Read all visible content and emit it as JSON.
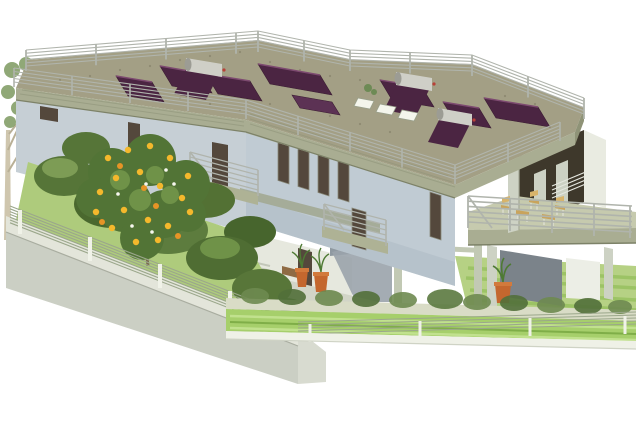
{
  "meta": {
    "title": "Architectural 3D rendering: modern two-storey villa with flat roof terrace, rooftop solar thermal panels, balconies, gardens and fenced retaining wall",
    "type": "3d-architectural-visualization",
    "objects": [
      "roof-terrace-with-railing",
      "solar-thermal-panels",
      "solar-water-heaters",
      "skylights",
      "left-wing-facade",
      "central-facade-windows",
      "balconies",
      "covered-porch",
      "large-terrace-with-furniture",
      "pilotis-columns",
      "ground-patio",
      "terracotta-planters",
      "citrus-tree-with-fruit",
      "background-tree",
      "left-garden-shrubs",
      "retaining-wall-with-wire-fence",
      "front-hedge-row",
      "front-fence",
      "striped-lawn"
    ]
  },
  "colors": {
    "background": "#ffffff",
    "roof_deck": "#a39f85",
    "roof_fascia": "#a9ad92",
    "roof_fascia_dark": "#8f9377",
    "deck_stripe": "#8f9579",
    "speckle": "#7e7862",
    "facade": "#c0cbd3",
    "facade_shade": "#aab7c0",
    "facade_left": "#c6cfd5",
    "window_glass": "#54483c",
    "porch_dark": "#3e382b",
    "porch_panel": "#ccd1c3",
    "panel": "#4b2542",
    "panel_edge": "#7d4a70",
    "panel_flat": "#5c3254",
    "tank": "#cfcfc7",
    "tank_cap": "#9c9c94",
    "tank_dot": "#b84038",
    "railing_gray": "#b0b4ac",
    "railing_white": "#e5e7df",
    "terrace_floor": "#c6caae",
    "slab": "#a9ad92",
    "column": "#cdd2c4",
    "column_green": "#c2c9b4",
    "shadow_wall": "#7b838a",
    "stair_shadow": "#9aa3ab",
    "ground_wall": "#e6e8de",
    "patio": "#d2d5c7",
    "wall_top": "#e3e5da",
    "wall_face": "#cbcfc4",
    "wall_end": "#d8dbd0",
    "fence_wire": "#9ba78b",
    "fence_post": "#f0f2e8",
    "lawn_left": "#aecb7c",
    "lawn_right": "#b6d184",
    "lawn_stripe": "#96c05e",
    "path_tan": "#d9dcc6",
    "band_bright": "#a6cf6b",
    "band_stripe": "#c4e292",
    "curb": "#eff1e7",
    "hedge_dark": "#52703a",
    "hedge_mid": "#6e8a50",
    "blob_dark": "#4a682e",
    "blob_mid": "#567538",
    "blob_light": "#7d9c55",
    "citrus_green": "#527436",
    "citrus_light": "#6f9248",
    "fruit_yellow": "#f4b82c",
    "fruit_orange": "#e69426",
    "blossom": "#f7f7ef",
    "trunk": "#7a6a4e",
    "bg_trunk": "#cfc6ae",
    "bg_leaf": "#7d9a60",
    "terracotta": "#c4672e",
    "terracotta_rim": "#d27a3c",
    "plant_blade": "#4e7a34",
    "furniture_tan": "#c9a45c",
    "furniture_back": "#d8b46a",
    "bench_wood": "#8f6b44",
    "skylight": "#f4f5ec"
  }
}
